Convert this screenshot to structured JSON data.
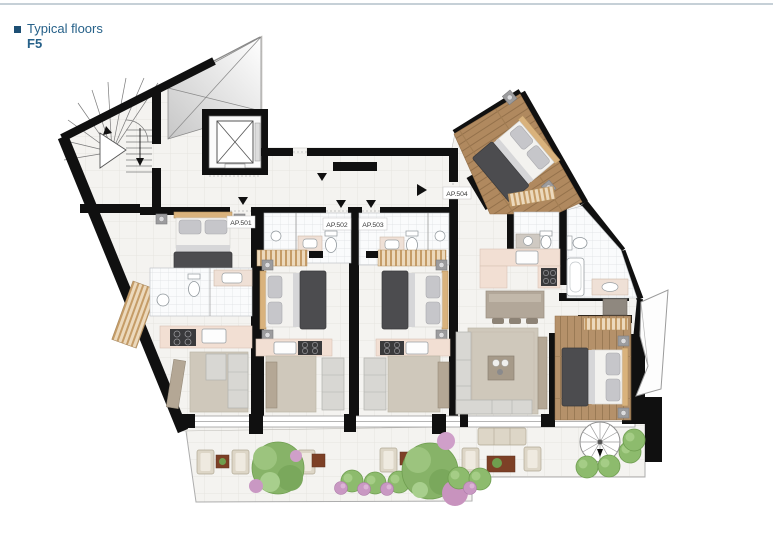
{
  "header": {
    "rule_color": "#c6d0d7",
    "bullet_color": "#1d4f74",
    "title": "Typical floors",
    "floor": "F5",
    "text_color": "#266189"
  },
  "plan": {
    "apartments": [
      {
        "id": "ap-501",
        "label": "AP.501"
      },
      {
        "id": "ap-502",
        "label": "AP.502"
      },
      {
        "id": "ap-503",
        "label": "AP.503"
      },
      {
        "id": "ap-504",
        "label": "AP.504"
      }
    ],
    "colors": {
      "wall": "#101010",
      "floor_tile": "#f4f3f0",
      "bath_tile": "#fafbfc",
      "wood_floor": "#b5916a",
      "closet_wood": "#cda06b",
      "bed_blanket": "#4c4c4f",
      "bed_duvet": "#f3f2ef",
      "counter": "#f2dfd3",
      "kitchen_island": "#b2a799",
      "rug": "#cfc8bb",
      "sofa": "#d8d7d3",
      "plant_green": "#87b368",
      "plant_pink": "#c998c3",
      "table_wood": "#7d4026"
    }
  }
}
